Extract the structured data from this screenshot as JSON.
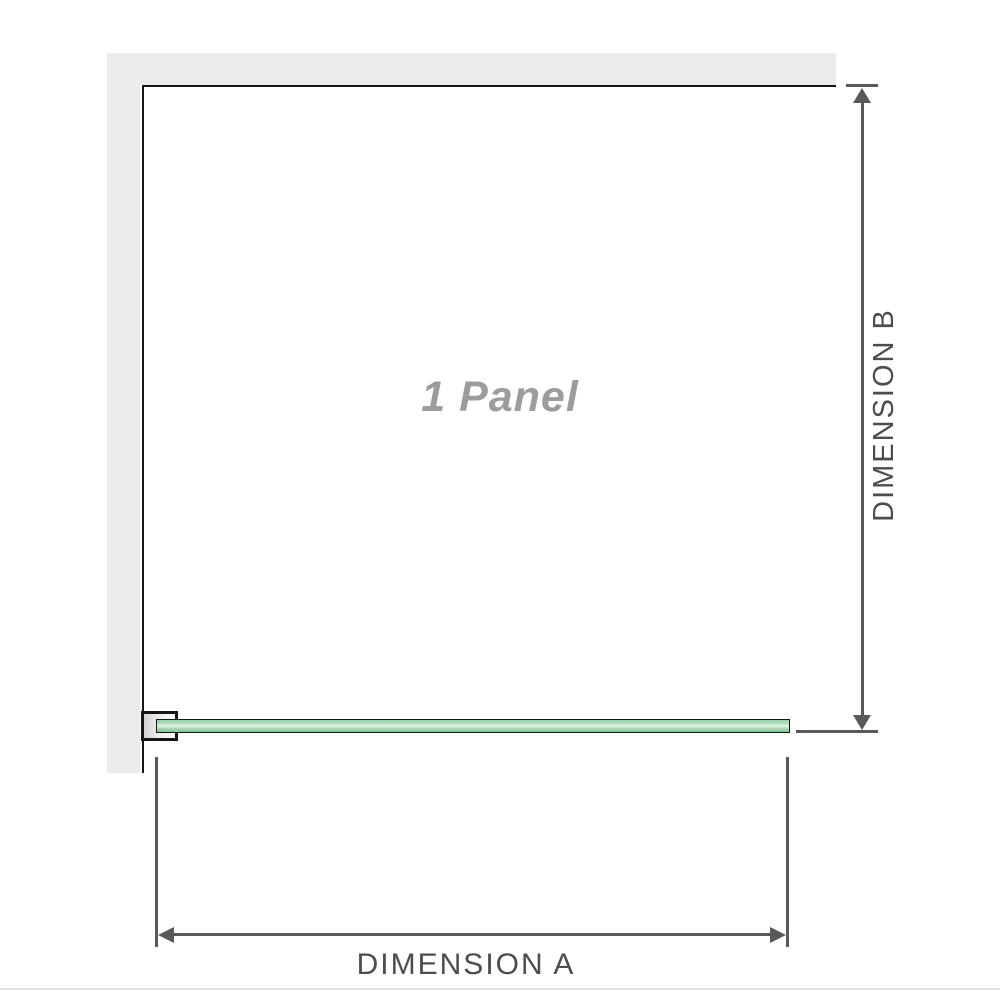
{
  "diagram": {
    "panel_label": "1 Panel",
    "dimension_a_label": "DIMENSION A",
    "dimension_b_label": "DIMENSION B"
  },
  "colors": {
    "wall": "#ebebeb",
    "outline": "#161616",
    "dimension_line": "#58595b",
    "dimension_text": "#4d4d4d",
    "panel_text": "#9c9c9c",
    "glass_green": "#97cfa8",
    "glass_green_light": "#e3f4e8",
    "glass_green_dark": "#86c498",
    "bracket_gray": "#d2d2d2",
    "separator": "#e4e2dd"
  }
}
